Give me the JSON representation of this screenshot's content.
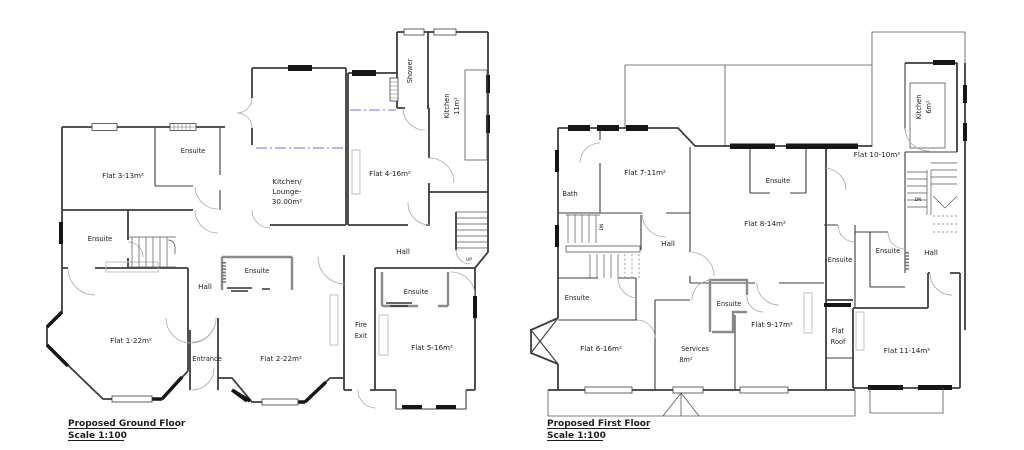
{
  "ground": {
    "title": "Proposed Ground Floor ",
    "scale": "Scale 1:100",
    "labels": {
      "flat1": "Flat 1-22m²",
      "flat2": "Flat 2-22m²",
      "flat3": "Flat 3-13m²",
      "flat4": "Flat 4-16m²",
      "flat5": "Flat 5-16m²",
      "ensuite_flat3": "Ensuite",
      "ensuite_left": "Ensuite",
      "ensuite_flat2": "Ensuite",
      "ensuite_flat5": "Ensuite",
      "hall_left": "Hall",
      "hall_right": "Hall",
      "entrance": "Entrance",
      "fire1": "Fire",
      "fire2": "Exit",
      "kl1": "Kitchen/",
      "kl2": "Lounge-",
      "kl3": "30.00m²",
      "kitchen1": "Kitchen",
      "kitchen2": "11m²",
      "shower": "Shower",
      "up": "UP"
    }
  },
  "first": {
    "title": "Proposed First Floor ",
    "scale": "Scale 1:100",
    "labels": {
      "bath": "Bath",
      "flat6": "Flat 6-16m²",
      "flat7": "Flat 7-11m²",
      "flat8": "Flat 8-14m²",
      "flat9": "Flat 9-17m²",
      "flat10": "Flat 10-10m²",
      "flat11": "Flat 11-14m²",
      "services1": "Services",
      "services2": "8m²",
      "kitchen1": "Kitchen",
      "kitchen2": "6m²",
      "hall_left": "Hall",
      "hall_right": "Hall",
      "ensuite_left": "Ensuite",
      "ensuite_flat8": "Ensuite",
      "ensuite_mid": "Ensuite",
      "ensuite_strip": "Ensuite",
      "ensuite_right": "Ensuite",
      "flatroof1": "Flat",
      "flatroof2": "Roof",
      "dn_left": "DN",
      "dn_right": "DN"
    }
  }
}
